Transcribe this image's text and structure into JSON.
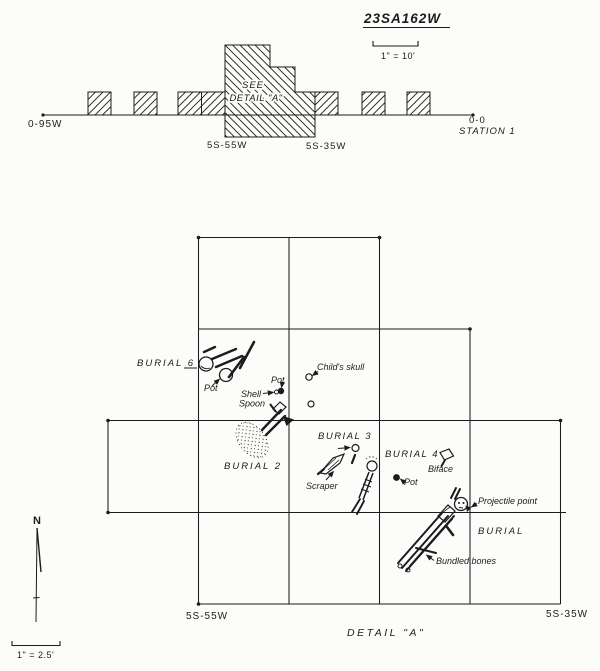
{
  "colors": {
    "ink": "#1c1c1c",
    "paper": "#fcfcfa"
  },
  "site_plan": {
    "title": "23SA162W",
    "scale_label": "1\" = 10'",
    "west_label": "0-95W",
    "origin_label": "0-0",
    "station_label": "STATION 1",
    "see_line1": "SEE",
    "see_line2": "DETAIL \"A\"",
    "unit_left": "5S-55W",
    "unit_right": "5S-35W"
  },
  "detail_plan": {
    "north_label": "N",
    "scale_label": "1\" = 2.5'",
    "caption": "DETAIL \"A\"",
    "corner_left": "5S-55W",
    "corner_right": "5S-35W",
    "labels": {
      "burial6": "BURIAL 6",
      "burial6_pot": "Pot",
      "pot_small": "Pot",
      "shell_line1": "Shell",
      "shell_line2": "Spoon",
      "childs_skull": "Child's skull",
      "burial2": "BURIAL 2",
      "burial3": "BURIAL 3",
      "scraper": "Scraper",
      "burial4": "BURIAL 4",
      "burial4_pot": "Pot",
      "biface": "Biface",
      "projectile_point": "Projectile point",
      "burial_bundled": "BURIAL",
      "bundled_bones": "Bundled bones"
    }
  }
}
